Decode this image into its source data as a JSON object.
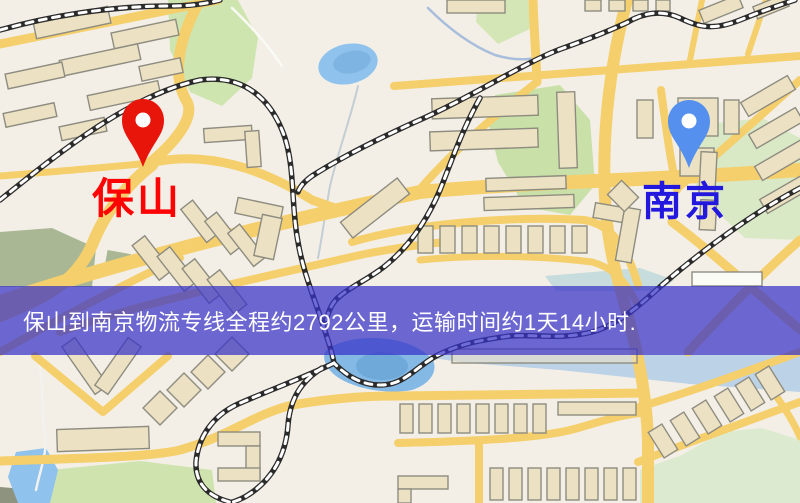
{
  "origin": {
    "name": "保山",
    "pin_color": "#e8150b",
    "label_color": "#fe0303"
  },
  "destination": {
    "name": "南京",
    "pin_color": "#5590ee",
    "label_color": "#2318dd"
  },
  "banner": {
    "text": "保山到南京物流专线全程约2792公里，运输时间约1天14小时.",
    "background_color": "#3732c8",
    "background_opacity": "0.72",
    "text_color": "#ffffff"
  },
  "map": {
    "land_color": "#f3efe6",
    "road_color": "#f5cf6b",
    "building_fill": "#ece2c3",
    "building_stroke": "#8e8c80",
    "green_color": "#cfe5b0",
    "green_dark_color": "#a9b795",
    "water_color": "#8fc2ec",
    "railway_color": "#2b2b2b"
  }
}
